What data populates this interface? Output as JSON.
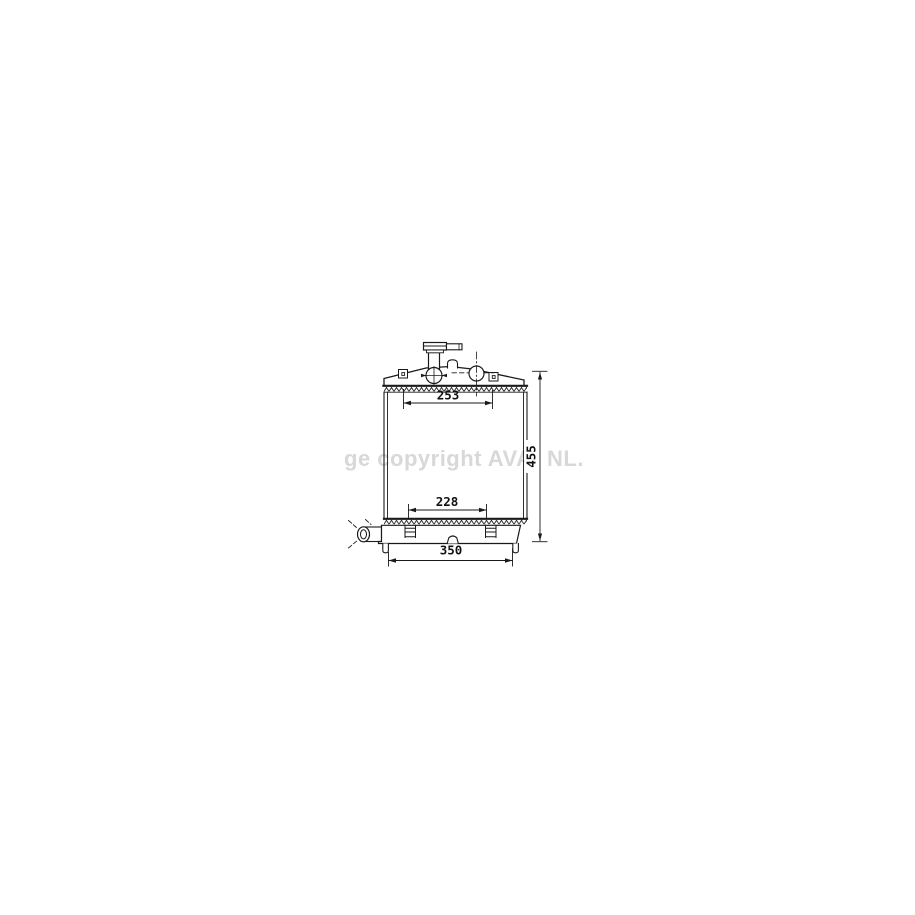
{
  "watermark": {
    "left": "ge copyright AVA.",
    "right": "NL.",
    "color": "#d8d8d8"
  },
  "diagram": {
    "line_color": "#1a1a1a",
    "dimensions": {
      "upper_mount_width": "253",
      "lower_bracket_width": "228",
      "overall_width": "350",
      "overall_height": "455"
    }
  }
}
